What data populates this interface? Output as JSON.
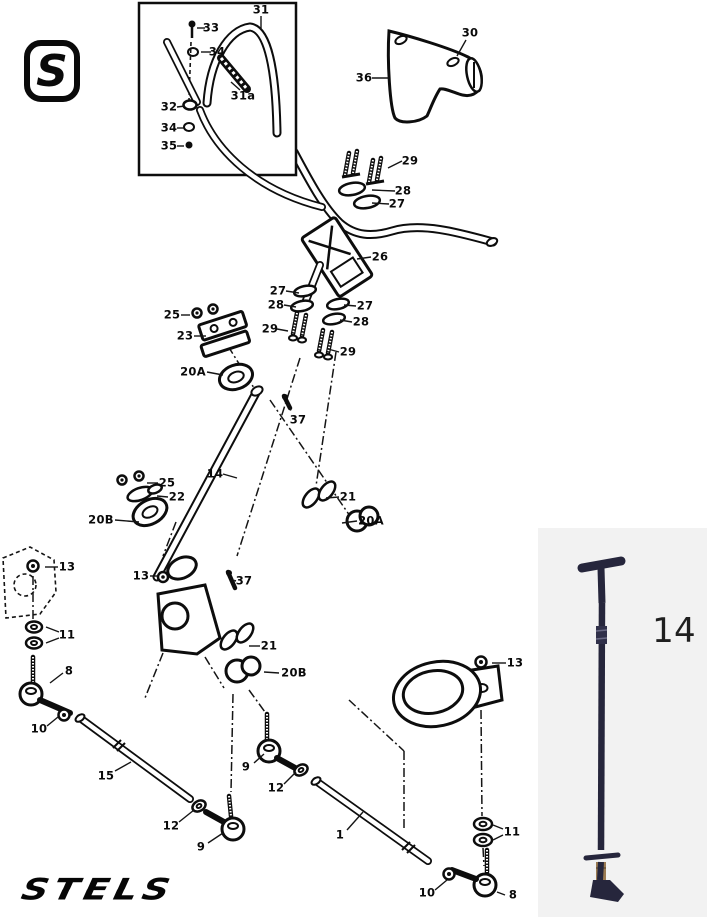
{
  "page": {
    "background": "#ffffff"
  },
  "brand": {
    "badge_letter": "S",
    "wordmark": "STELS"
  },
  "photo_panel": {
    "background": "#f2f2f2",
    "shaft_color": "#26263c",
    "brass_color": "#9b7b52"
  },
  "diagram": {
    "line_color": "#111111",
    "labels": [
      {
        "text": "33",
        "x": 211,
        "y": 28
      },
      {
        "text": "34",
        "x": 217,
        "y": 52
      },
      {
        "text": "31",
        "x": 261,
        "y": 10
      },
      {
        "text": "31a",
        "x": 243,
        "y": 96
      },
      {
        "text": "32",
        "x": 169,
        "y": 107
      },
      {
        "text": "34",
        "x": 169,
        "y": 128
      },
      {
        "text": "35",
        "x": 169,
        "y": 146
      },
      {
        "text": "30",
        "x": 470,
        "y": 33
      },
      {
        "text": "36",
        "x": 364,
        "y": 78
      },
      {
        "text": "29",
        "x": 410,
        "y": 161
      },
      {
        "text": "28",
        "x": 403,
        "y": 191
      },
      {
        "text": "27",
        "x": 397,
        "y": 204
      },
      {
        "text": "26",
        "x": 380,
        "y": 257
      },
      {
        "text": "27",
        "x": 278,
        "y": 291
      },
      {
        "text": "28",
        "x": 276,
        "y": 305
      },
      {
        "text": "29",
        "x": 270,
        "y": 329
      },
      {
        "text": "27",
        "x": 365,
        "y": 306
      },
      {
        "text": "28",
        "x": 361,
        "y": 322
      },
      {
        "text": "29",
        "x": 348,
        "y": 352
      },
      {
        "text": "25",
        "x": 172,
        "y": 315
      },
      {
        "text": "23",
        "x": 185,
        "y": 336
      },
      {
        "text": "20A",
        "x": 193,
        "y": 372
      },
      {
        "text": "37",
        "x": 298,
        "y": 420
      },
      {
        "text": "14",
        "x": 215,
        "y": 474
      },
      {
        "text": "21",
        "x": 348,
        "y": 497
      },
      {
        "text": "20A",
        "x": 371,
        "y": 521
      },
      {
        "text": "25",
        "x": 167,
        "y": 483
      },
      {
        "text": "22",
        "x": 177,
        "y": 497
      },
      {
        "text": "20B",
        "x": 101,
        "y": 520
      },
      {
        "text": "13",
        "x": 67,
        "y": 567
      },
      {
        "text": "11",
        "x": 67,
        "y": 635
      },
      {
        "text": "8",
        "x": 69,
        "y": 671
      },
      {
        "text": "10",
        "x": 39,
        "y": 729
      },
      {
        "text": "13",
        "x": 141,
        "y": 576
      },
      {
        "text": "37",
        "x": 244,
        "y": 581
      },
      {
        "text": "21",
        "x": 269,
        "y": 646
      },
      {
        "text": "20B",
        "x": 294,
        "y": 673
      },
      {
        "text": "13",
        "x": 515,
        "y": 663
      },
      {
        "text": "15",
        "x": 106,
        "y": 776
      },
      {
        "text": "12",
        "x": 171,
        "y": 826
      },
      {
        "text": "9",
        "x": 201,
        "y": 847
      },
      {
        "text": "9",
        "x": 246,
        "y": 767
      },
      {
        "text": "12",
        "x": 276,
        "y": 788
      },
      {
        "text": "1",
        "x": 340,
        "y": 835
      },
      {
        "text": "11",
        "x": 512,
        "y": 832
      },
      {
        "text": "10",
        "x": 427,
        "y": 893
      },
      {
        "text": "8",
        "x": 513,
        "y": 895
      },
      {
        "text": "14",
        "x": 674,
        "y": 631,
        "size": 34,
        "weight": "400",
        "color": "#1f1f1f"
      }
    ]
  }
}
